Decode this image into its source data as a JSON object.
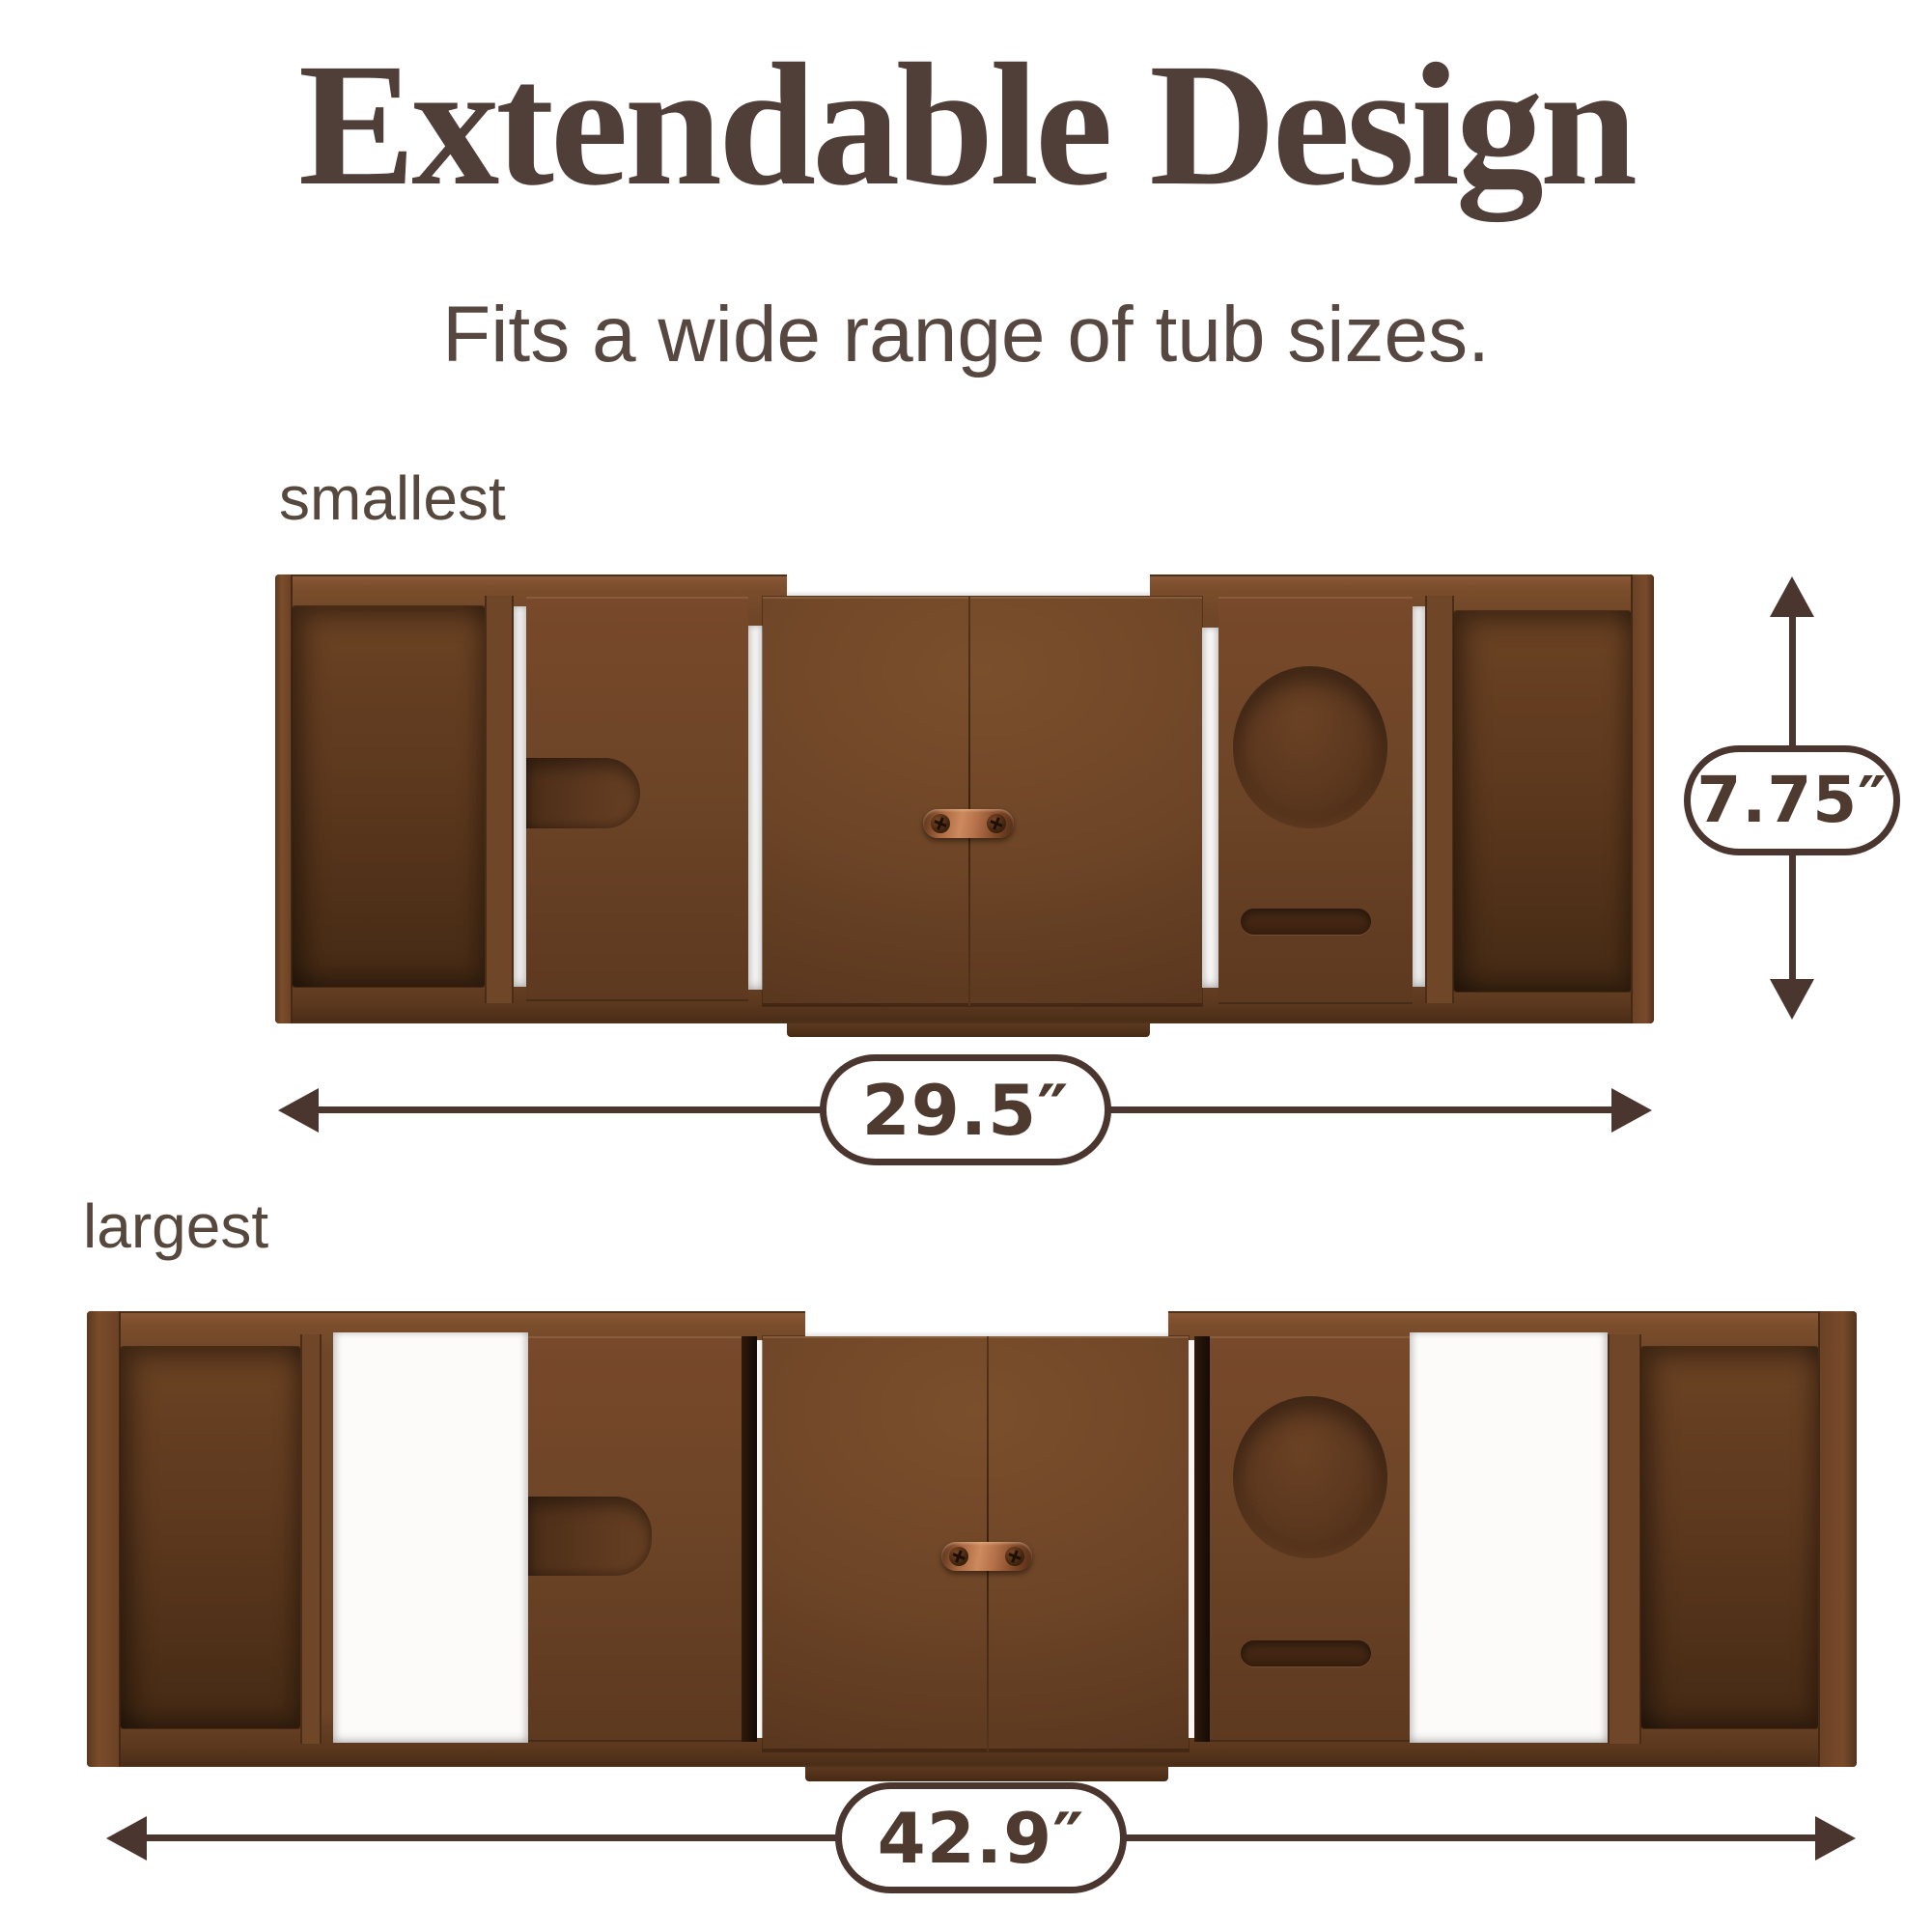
{
  "header": {
    "title": "Extendable Design",
    "subtitle": "Fits a wide range of tub sizes."
  },
  "variants": {
    "smallest": {
      "label": "smallest",
      "width": "29.5″",
      "height": "7.75″"
    },
    "largest": {
      "label": "largest",
      "width": "42.9″"
    }
  },
  "icons": {
    "width_dimension": "horizontal-double-arrow",
    "height_dimension": "vertical-double-arrow"
  },
  "colors": {
    "background": "#ffffff",
    "wood": "#6e4527",
    "wood_dark": "#4a2c16",
    "wood_light": "#8a5836",
    "copper_handle": "#b5714a",
    "dimension_ink": "#4a362e",
    "title_text": "#4f3f38",
    "subtitle_text": "#564740",
    "label_text": "#57483e"
  }
}
